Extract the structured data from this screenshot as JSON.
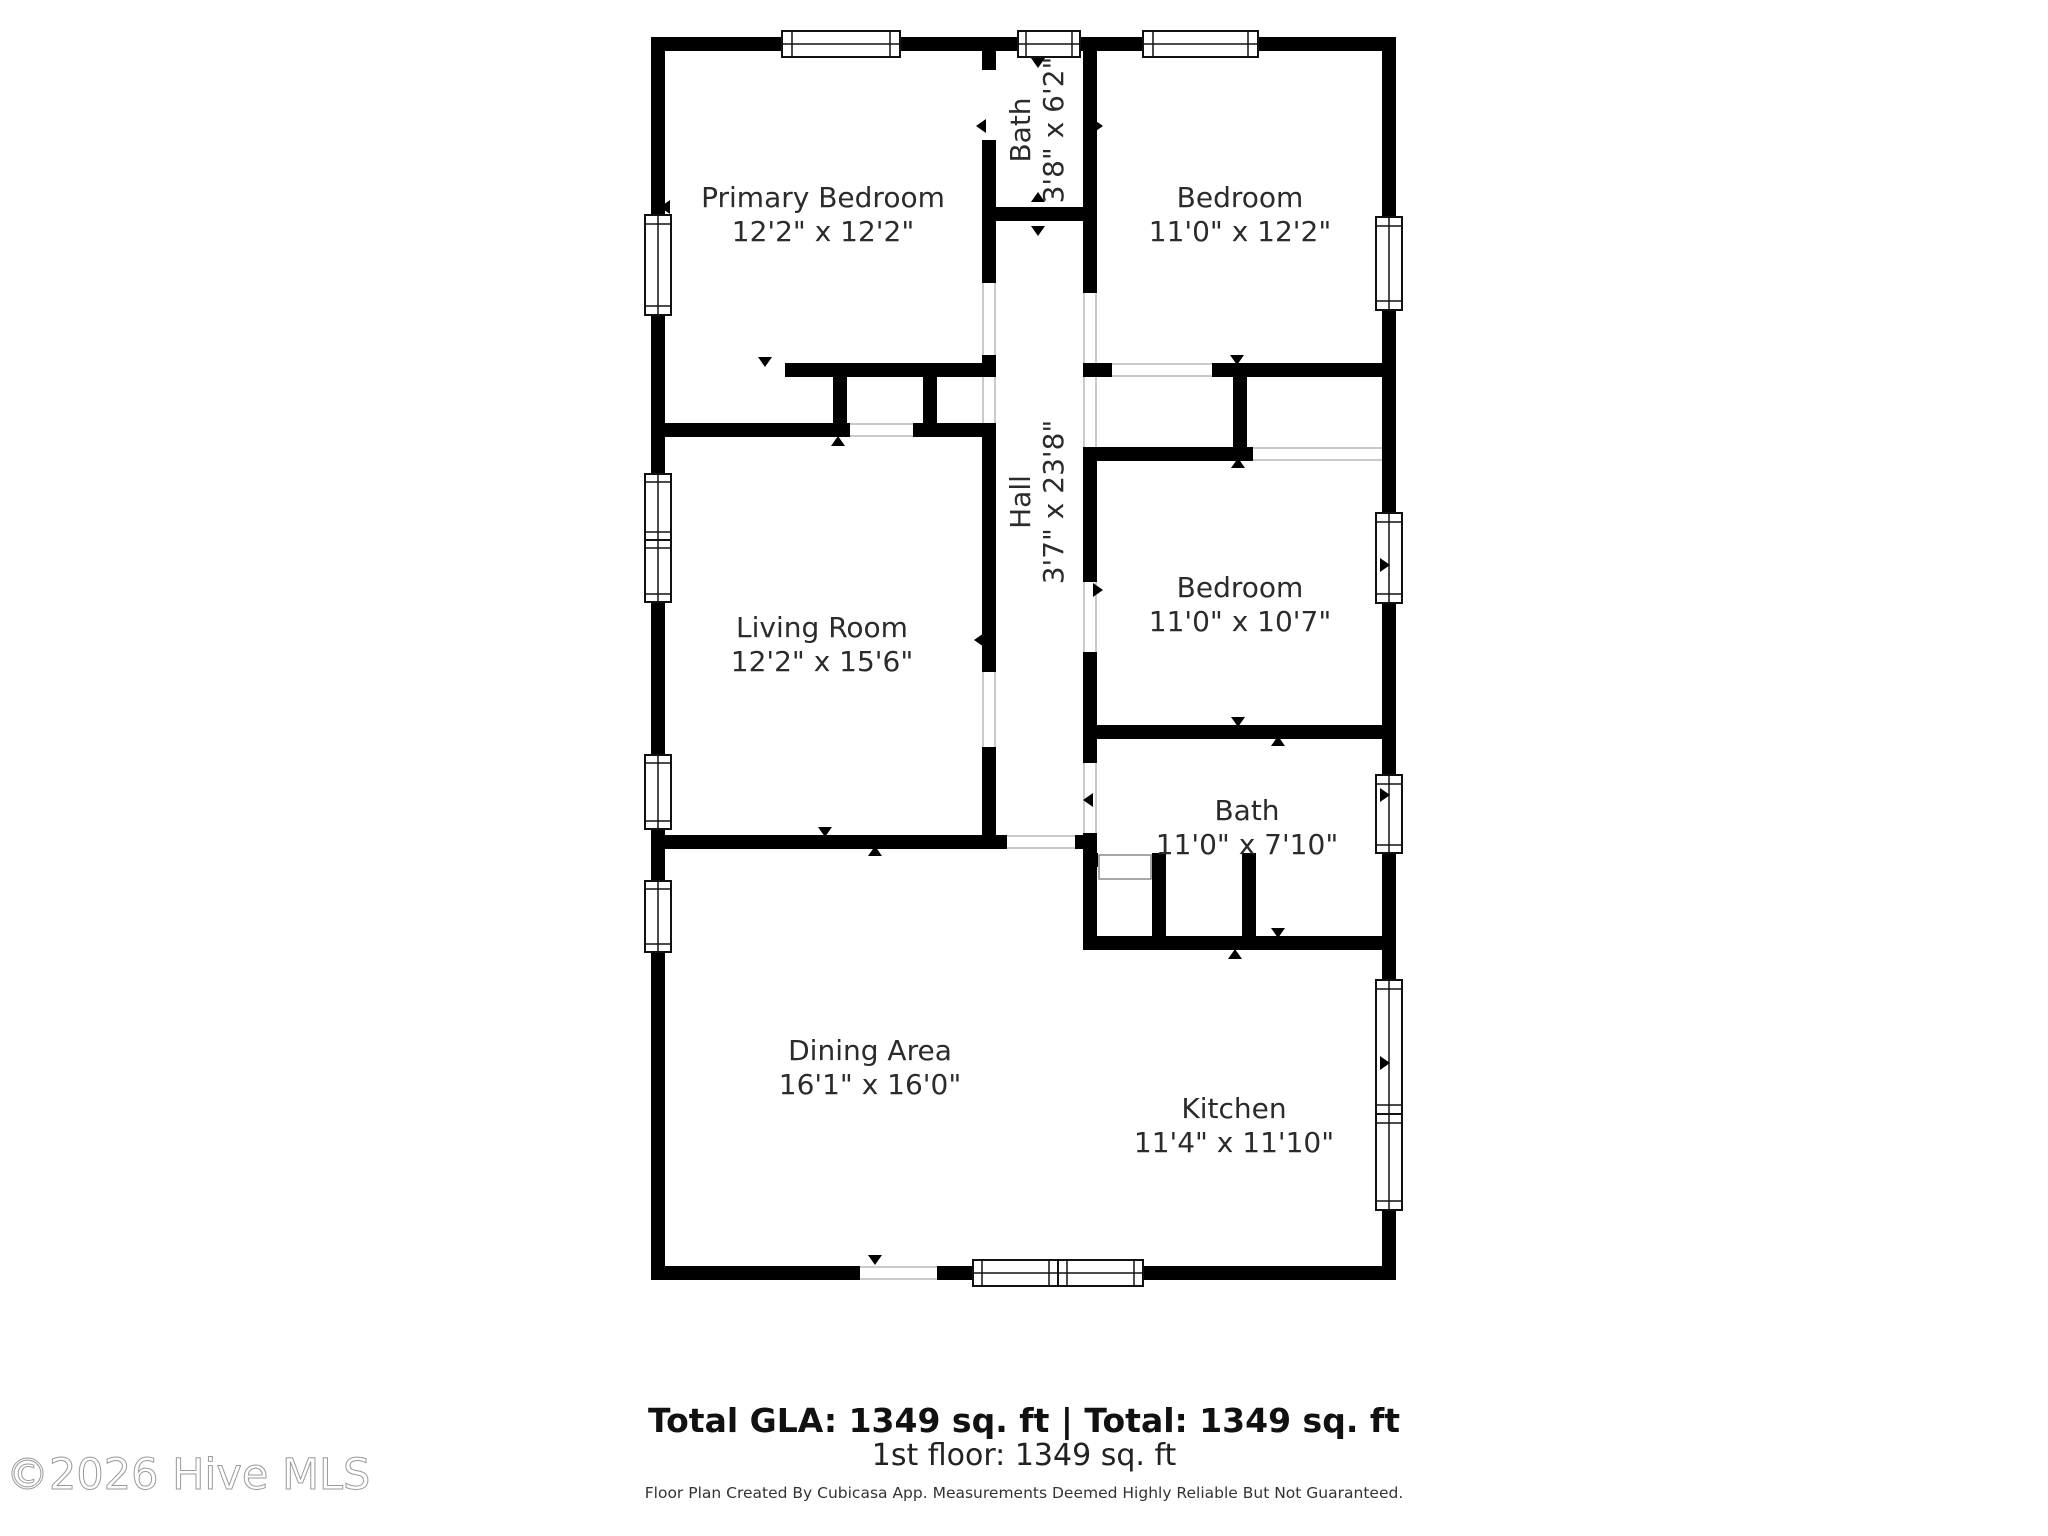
{
  "plan": {
    "rooms": [
      {
        "name": "Primary Bedroom",
        "dims": "12'2\" x 12'2\""
      },
      {
        "name": "Bath",
        "dims": "3'8\" x 6'2\""
      },
      {
        "name": "Bedroom",
        "dims": "11'0\" x 12'2\""
      },
      {
        "name": "Hall",
        "dims": "3'7\" x 23'8\""
      },
      {
        "name": "Living Room",
        "dims": "12'2\" x 15'6\""
      },
      {
        "name": "Bedroom",
        "dims": "11'0\" x 10'7\""
      },
      {
        "name": "Bath",
        "dims": "11'0\" x 7'10\""
      },
      {
        "name": "Dining Area",
        "dims": "16'1\" x 16'0\""
      },
      {
        "name": "Kitchen",
        "dims": "11'4\" x 11'10\""
      }
    ],
    "summary": {
      "total_line": "Total GLA: 1349 sq. ft | Total: 1349 sq. ft",
      "floor_line": "1st floor: 1349 sq. ft",
      "disclaimer": "Floor Plan Created By Cubicasa App. Measurements Deemed Highly Reliable But Not Guaranteed."
    },
    "watermark": "©2026 Hive MLS",
    "colors": {
      "wall": "#000000",
      "background": "#ffffff",
      "label": "#2b2b2b",
      "watermark_stroke": "#9a9a9a"
    }
  }
}
